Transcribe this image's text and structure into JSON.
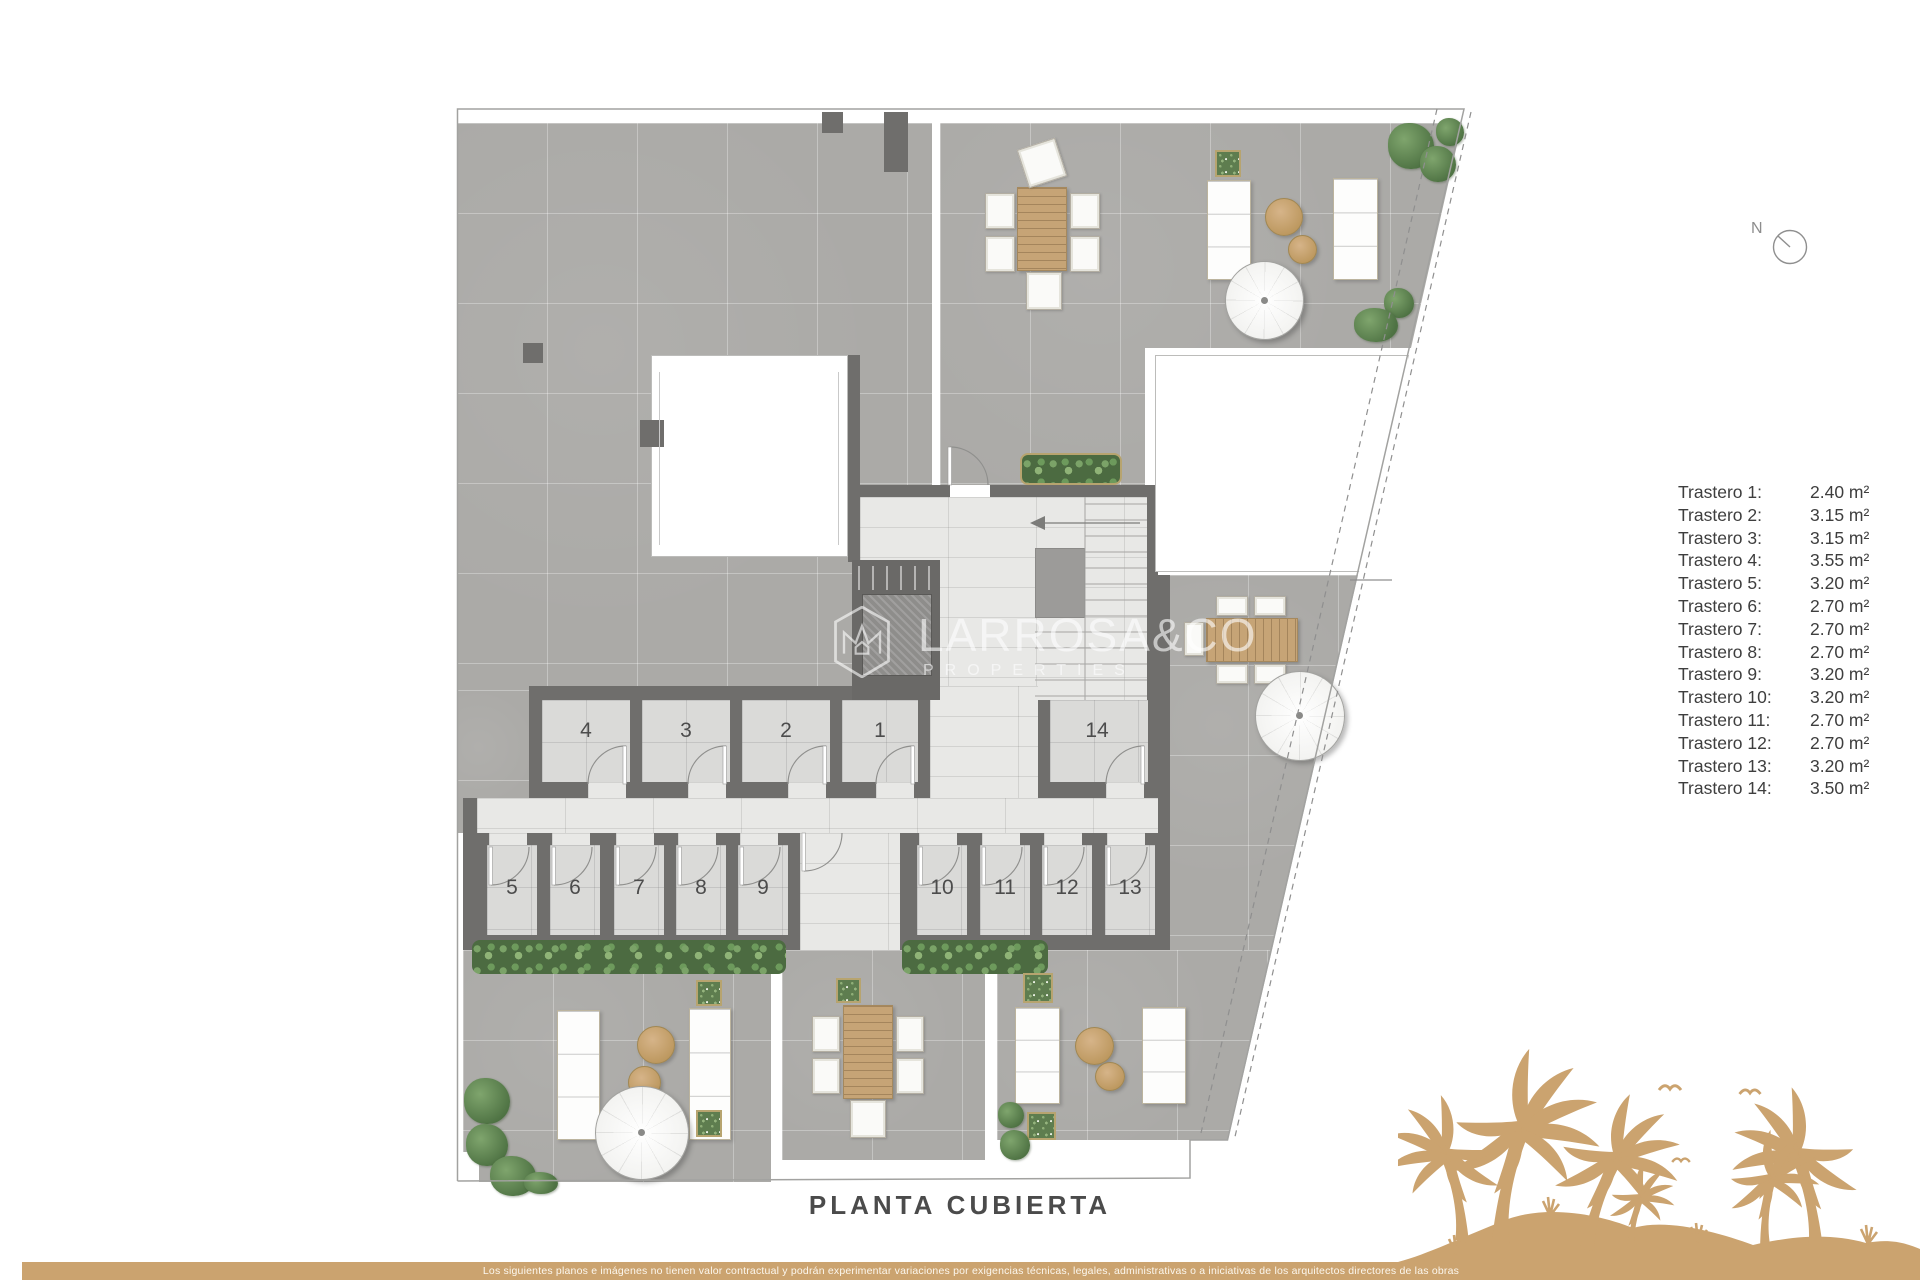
{
  "page": {
    "plan_title": "PLANTA CUBIERTA",
    "compass_n": "N",
    "disclaimer": "Los siguientes planos e imágenes no tienen valor contractual y podrán experimentar variaciones por exigencias técnicas, legales, administrativas o a iniciativas de los arquitectos directores de las obras"
  },
  "watermark": {
    "brand": "LARROSA&CO",
    "sub": "PROPERTIES"
  },
  "legend": {
    "items": [
      {
        "label": "Trastero 1:",
        "value": "2.40 m²"
      },
      {
        "label": "Trastero 2:",
        "value": "3.15 m²"
      },
      {
        "label": "Trastero 3:",
        "value": "3.15 m²"
      },
      {
        "label": "Trastero 4:",
        "value": "3.55 m²"
      },
      {
        "label": "Trastero 5:",
        "value": "3.20 m²"
      },
      {
        "label": "Trastero 6:",
        "value": "2.70 m²"
      },
      {
        "label": "Trastero 7:",
        "value": "2.70 m²"
      },
      {
        "label": "Trastero 8:",
        "value": "2.70 m²"
      },
      {
        "label": "Trastero 9:",
        "value": "3.20 m²"
      },
      {
        "label": "Trastero 10:",
        "value": "3.20 m²"
      },
      {
        "label": "Trastero 11:",
        "value": "2.70 m²"
      },
      {
        "label": "Trastero 12:",
        "value": "2.70 m²"
      },
      {
        "label": "Trastero 13:",
        "value": "3.20 m²"
      },
      {
        "label": "Trastero 14:",
        "value": "3.50 m²"
      }
    ]
  },
  "rooms": {
    "r1": "1",
    "r2": "2",
    "r3": "3",
    "r4": "4",
    "r5": "5",
    "r6": "6",
    "r7": "7",
    "r8": "8",
    "r9": "9",
    "r10": "10",
    "r11": "11",
    "r12": "12",
    "r13": "13",
    "r14": "14"
  },
  "colors": {
    "accent_tan": "#cba36f",
    "wall": "#6f6e6c",
    "terrace": "#abaaa7",
    "room_floor": "#dadad8",
    "corridor": "#e8e8e6",
    "text_dark": "#3e3e3e"
  }
}
